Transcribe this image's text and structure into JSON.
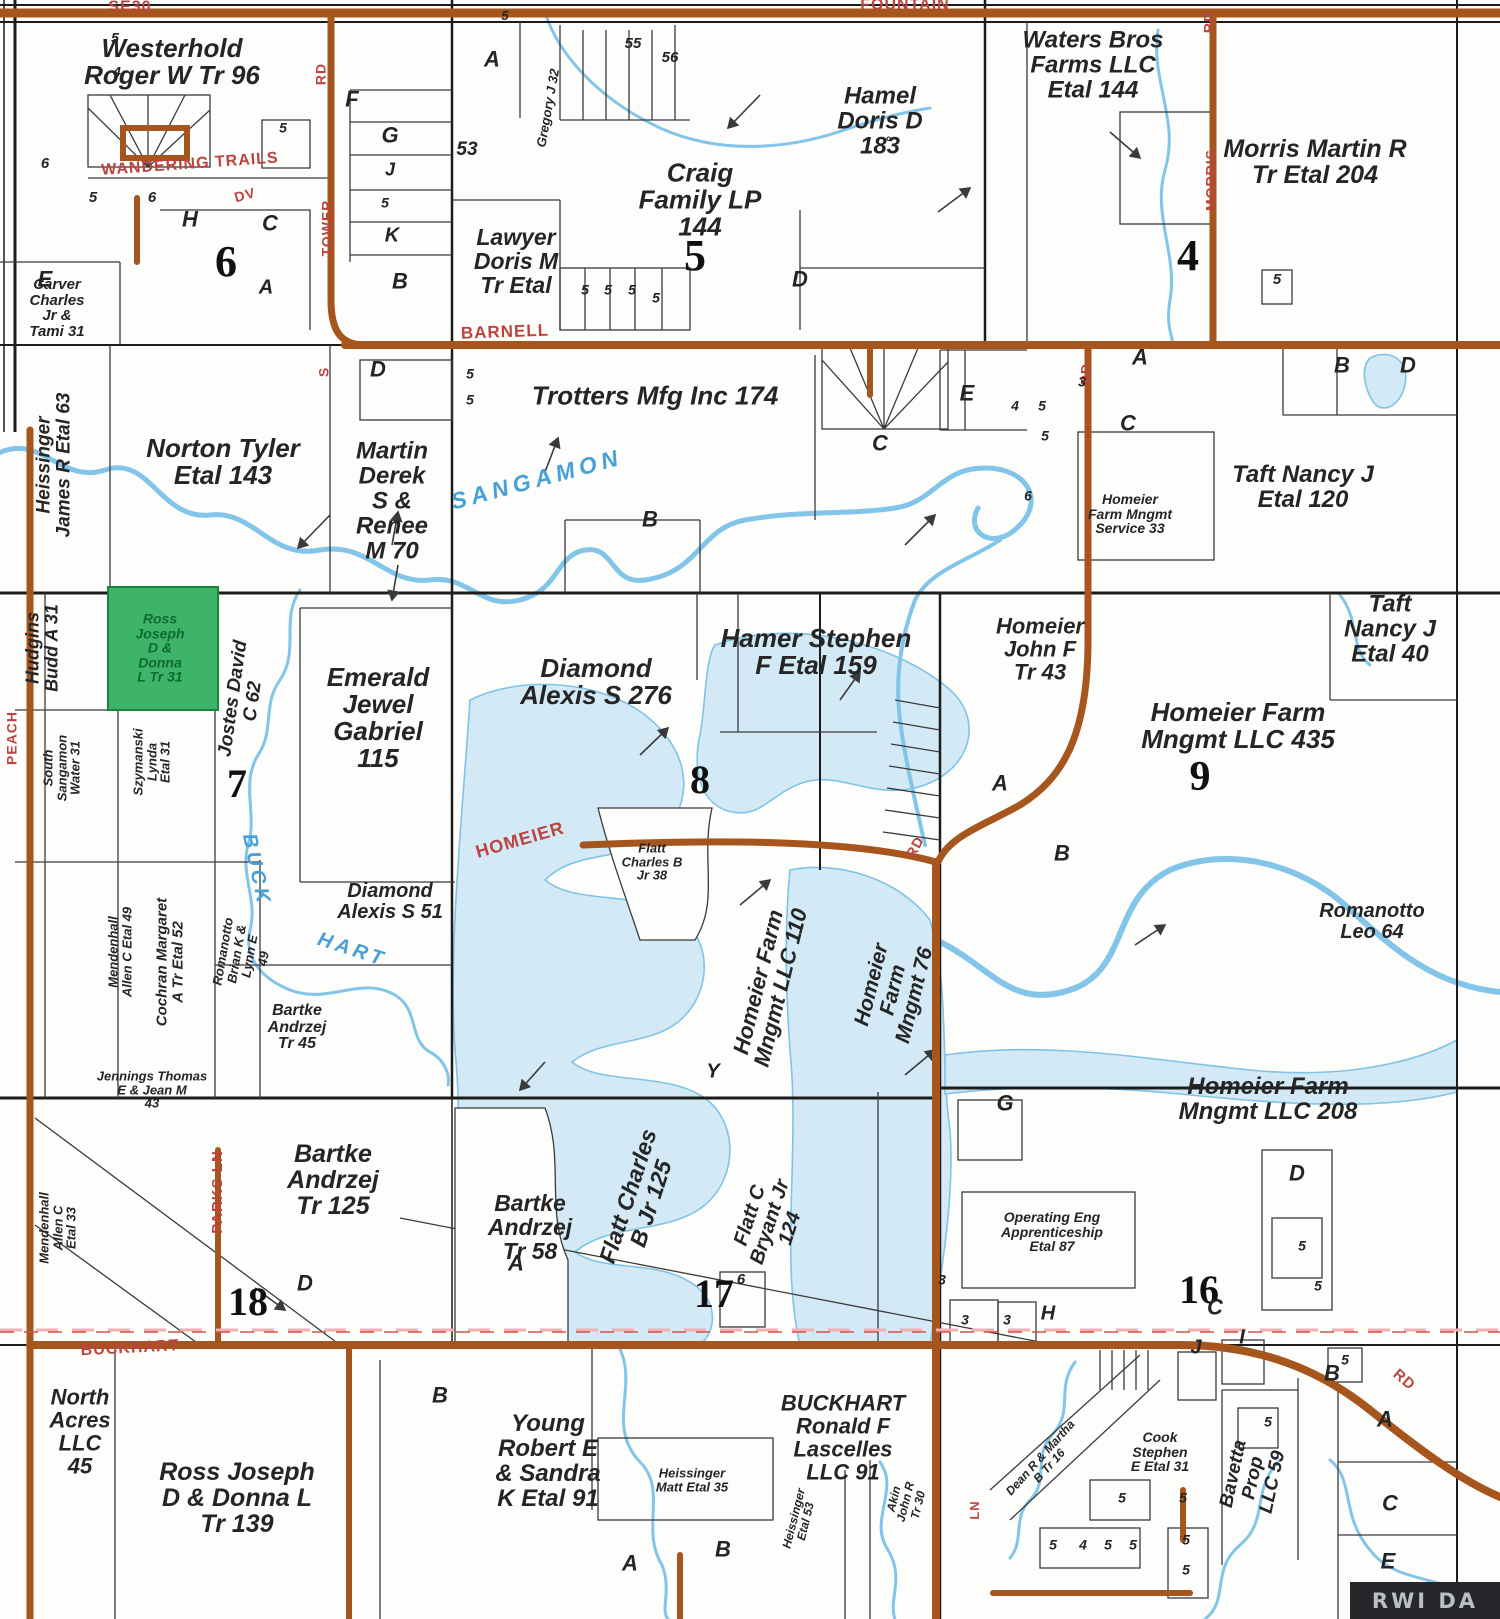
{
  "map_title": "Plat map - township land ownership",
  "colors": {
    "road_brown": "#a6561d",
    "road_label_red": "#bc4340",
    "water_fill": "#d3e9f6",
    "water_stroke": "#7fc4e6",
    "highlight_green": "#3db468",
    "highlight_text": "#0d6b33",
    "parcel_line": "#3a3a3a",
    "section_line": "#1c1c1c"
  },
  "highlight_parcel": {
    "owner": "Ross Joseph D & Donna L Tr 31"
  },
  "watermark": {
    "text": "RWI DA"
  },
  "sections": [
    {
      "t": "6",
      "x": 226,
      "y": 262,
      "fs": 44
    },
    {
      "t": "5",
      "x": 695,
      "y": 256,
      "fs": 44
    },
    {
      "t": "4",
      "x": 1188,
      "y": 256,
      "fs": 44
    },
    {
      "t": "7",
      "x": 237,
      "y": 784,
      "fs": 40
    },
    {
      "t": "8",
      "x": 700,
      "y": 780,
      "fs": 40
    },
    {
      "t": "9",
      "x": 1200,
      "y": 778,
      "fs": 42
    },
    {
      "t": "18",
      "x": 248,
      "y": 1302,
      "fs": 40
    },
    {
      "t": "17",
      "x": 714,
      "y": 1294,
      "fs": 40
    },
    {
      "t": "16",
      "x": 1199,
      "y": 1290,
      "fs": 40
    }
  ],
  "parcels": [
    {
      "id": "westerhold",
      "lines": [
        "Westerhold",
        "Roger W Tr 96"
      ],
      "x": 172,
      "y": 62,
      "fs": 26
    },
    {
      "id": "carver",
      "lines": [
        "Carver",
        "Charles",
        "Jr &",
        "Tami 31"
      ],
      "x": 57,
      "y": 308,
      "fs": 15
    },
    {
      "id": "craig",
      "lines": [
        "Craig",
        "Family LP",
        "144"
      ],
      "x": 700,
      "y": 200,
      "fs": 26
    },
    {
      "id": "lawyer",
      "lines": [
        "Lawyer",
        "Doris M",
        "Tr Etal"
      ],
      "x": 516,
      "y": 262,
      "fs": 23
    },
    {
      "id": "hamel",
      "lines": [
        "Hamel",
        "Doris D",
        "183"
      ],
      "x": 880,
      "y": 122,
      "fs": 24
    },
    {
      "id": "waters-bros",
      "lines": [
        "Waters Bros",
        "Farms LLC",
        "Etal 144"
      ],
      "x": 1093,
      "y": 66,
      "fs": 24
    },
    {
      "id": "morris-martin",
      "lines": [
        "Morris Martin R",
        "Tr Etal 204"
      ],
      "x": 1315,
      "y": 162,
      "fs": 25
    },
    {
      "id": "trotters",
      "lines": [
        "Trotters Mfg Inc 174"
      ],
      "x": 655,
      "y": 396,
      "fs": 26
    },
    {
      "id": "norton",
      "lines": [
        "Norton Tyler",
        "Etal 143"
      ],
      "x": 223,
      "y": 462,
      "fs": 26
    },
    {
      "id": "martin-derek",
      "lines": [
        "Martin",
        "Derek",
        "S &",
        "Renee",
        "M 70"
      ],
      "x": 392,
      "y": 502,
      "fs": 24
    },
    {
      "id": "taft-120",
      "lines": [
        "Taft Nancy J",
        "Etal 120"
      ],
      "x": 1303,
      "y": 488,
      "fs": 24
    },
    {
      "id": "homeier-service",
      "lines": [
        "Homeier",
        "Farm Mngmt",
        "Service 33"
      ],
      "x": 1130,
      "y": 514,
      "fs": 14
    },
    {
      "id": "heissinger-63",
      "lines": [
        "Heissinger",
        "James R Etal 63"
      ],
      "x": 54,
      "y": 465,
      "fs": 19,
      "rot": -90
    },
    {
      "id": "hudgins",
      "lines": [
        "Hudgins",
        "Budd A 31"
      ],
      "x": 42,
      "y": 648,
      "fs": 18,
      "rot": -90
    },
    {
      "id": "ross-31",
      "lines": [
        "Ross",
        "Joseph",
        "D &",
        "Donna",
        "L Tr 31"
      ],
      "x": 160,
      "y": 648,
      "fs": 14,
      "c": "#0d6b33"
    },
    {
      "id": "south-sangamon",
      "lines": [
        "South",
        "Sangamon",
        "Water 31"
      ],
      "x": 62,
      "y": 768,
      "fs": 13,
      "rot": -90
    },
    {
      "id": "szymanski",
      "lines": [
        "Szymanski",
        "Lynda",
        "Etal 31"
      ],
      "x": 152,
      "y": 762,
      "fs": 13,
      "rot": -90
    },
    {
      "id": "jostes",
      "lines": [
        "Jostes David",
        "C 62"
      ],
      "x": 243,
      "y": 700,
      "fs": 19,
      "rot": -82
    },
    {
      "id": "emerald",
      "lines": [
        "Emerald",
        "Jewel",
        "Gabriel",
        "115"
      ],
      "x": 378,
      "y": 718,
      "fs": 26
    },
    {
      "id": "diamond-276",
      "lines": [
        "Diamond",
        "Alexis S 276"
      ],
      "x": 596,
      "y": 682,
      "fs": 26
    },
    {
      "id": "hamer",
      "lines": [
        "Hamer Stephen",
        "F Etal 159"
      ],
      "x": 816,
      "y": 652,
      "fs": 26
    },
    {
      "id": "homeier-john",
      "lines": [
        "Homeier",
        "John F",
        "Tr 43"
      ],
      "x": 1040,
      "y": 650,
      "fs": 22
    },
    {
      "id": "taft-40",
      "lines": [
        "Taft",
        "Nancy J",
        "Etal 40"
      ],
      "x": 1390,
      "y": 630,
      "fs": 24
    },
    {
      "id": "homeier-435",
      "lines": [
        "Homeier Farm",
        "Mngmt LLC 435"
      ],
      "x": 1238,
      "y": 726,
      "fs": 26
    },
    {
      "id": "mendenhall-49",
      "lines": [
        "Mendenhall",
        "Allen C Etal 49"
      ],
      "x": 120,
      "y": 952,
      "fs": 13,
      "rot": -90
    },
    {
      "id": "cochran",
      "lines": [
        "Cochran Margaret",
        "A Tr Etal 52"
      ],
      "x": 170,
      "y": 962,
      "fs": 15,
      "rot": -90
    },
    {
      "id": "romanotto-brian",
      "lines": [
        "Romanotto",
        "Brian K &",
        "Lynn E",
        "49"
      ],
      "x": 243,
      "y": 955,
      "fs": 13,
      "rot": -80
    },
    {
      "id": "diamond-51",
      "lines": [
        "Diamond",
        "Alexis S 51"
      ],
      "x": 390,
      "y": 902,
      "fs": 20
    },
    {
      "id": "flatt-38",
      "lines": [
        "Flatt",
        "Charles B",
        "Jr 38"
      ],
      "x": 652,
      "y": 862,
      "fs": 13
    },
    {
      "id": "homeier-110",
      "lines": [
        "Homeier Farm",
        "Mngmt LLC 110"
      ],
      "x": 770,
      "y": 985,
      "fs": 22,
      "rot": -76
    },
    {
      "id": "homeier-76",
      "lines": [
        "Homeier",
        "Farm",
        "Mngmt 76"
      ],
      "x": 893,
      "y": 990,
      "fs": 21,
      "rot": -76
    },
    {
      "id": "romanotto-leo",
      "lines": [
        "Romanotto",
        "Leo 64"
      ],
      "x": 1372,
      "y": 922,
      "fs": 20
    },
    {
      "id": "bartke-45",
      "lines": [
        "Bartke",
        "Andrzej",
        "Tr 45"
      ],
      "x": 297,
      "y": 1028,
      "fs": 16
    },
    {
      "id": "jennings",
      "lines": [
        "Jennings Thomas",
        "E & Jean M",
        "43"
      ],
      "x": 152,
      "y": 1090,
      "fs": 13
    },
    {
      "id": "bartke-125",
      "lines": [
        "Bartke",
        "Andrzej",
        "Tr 125"
      ],
      "x": 333,
      "y": 1180,
      "fs": 25
    },
    {
      "id": "bartke-58",
      "lines": [
        "Bartke",
        "Andrzej",
        "Tr 58"
      ],
      "x": 530,
      "y": 1228,
      "fs": 23
    },
    {
      "id": "flatt-125",
      "lines": [
        "Flatt Charles",
        "B Jr 125"
      ],
      "x": 640,
      "y": 1200,
      "fs": 23,
      "rot": -72
    },
    {
      "id": "flatt-124",
      "lines": [
        "Flatt C",
        "Bryant Jr",
        "124"
      ],
      "x": 770,
      "y": 1222,
      "fs": 20,
      "rot": -72
    },
    {
      "id": "homeier-208",
      "lines": [
        "Homeier Farm",
        "Mngmt LLC 208"
      ],
      "x": 1268,
      "y": 1100,
      "fs": 24
    },
    {
      "id": "operating-eng",
      "lines": [
        "Operating Eng",
        "Apprenticeship",
        "Etal 87"
      ],
      "x": 1052,
      "y": 1232,
      "fs": 14
    },
    {
      "id": "mendenhall-33",
      "lines": [
        "Mendenhall",
        "Allen C",
        "Etal 33"
      ],
      "x": 58,
      "y": 1228,
      "fs": 13,
      "rot": -90
    },
    {
      "id": "north-acres",
      "lines": [
        "North",
        "Acres",
        "LLC",
        "45"
      ],
      "x": 80,
      "y": 1432,
      "fs": 22
    },
    {
      "id": "ross-139",
      "lines": [
        "Ross Joseph",
        "D & Donna L",
        "Tr 139"
      ],
      "x": 237,
      "y": 1498,
      "fs": 25
    },
    {
      "id": "young",
      "lines": [
        "Young",
        "Robert E",
        "& Sandra",
        "K Etal 91"
      ],
      "x": 548,
      "y": 1462,
      "fs": 24
    },
    {
      "id": "heissinger-35",
      "lines": [
        "Heissinger",
        "Matt Etal 35"
      ],
      "x": 692,
      "y": 1480,
      "fs": 13
    },
    {
      "id": "lascelles",
      "lines": [
        "BUCKHART",
        "Ronald F",
        "Lascelles",
        "LLC 91"
      ],
      "x": 843,
      "y": 1438,
      "fs": 22
    },
    {
      "id": "cook",
      "lines": [
        "Cook",
        "Stephen",
        "E Etal 31"
      ],
      "x": 1160,
      "y": 1452,
      "fs": 14
    },
    {
      "id": "bavetta",
      "lines": [
        "Bavetta",
        "Prop",
        "LLC 59"
      ],
      "x": 1253,
      "y": 1478,
      "fs": 19,
      "rot": -78
    },
    {
      "id": "dean",
      "lines": [
        "Dean R & Martha",
        "B Tr 16"
      ],
      "x": 1045,
      "y": 1462,
      "fs": 12,
      "rot": -48
    },
    {
      "id": "akin",
      "lines": [
        "Akin",
        "John R",
        "Tr 30"
      ],
      "x": 906,
      "y": 1502,
      "fs": 12,
      "rot": -76
    },
    {
      "id": "heissinger-53",
      "lines": [
        "Heissinger",
        "Etal 53"
      ],
      "x": 800,
      "y": 1520,
      "fs": 12,
      "rot": -76
    },
    {
      "id": "gregory",
      "lines": [
        "Gregory J 32"
      ],
      "x": 548,
      "y": 108,
      "fs": 13,
      "rot": -80
    }
  ],
  "road_labels": [
    {
      "t": "SE30",
      "x": 130,
      "y": 8,
      "fs": 16
    },
    {
      "t": "FOUNTAIN",
      "x": 905,
      "y": 6,
      "fs": 16
    },
    {
      "t": "WANDERING TRAILS",
      "x": 190,
      "y": 165,
      "fs": 16,
      "rot": -4
    },
    {
      "t": "DV",
      "x": 245,
      "y": 195,
      "fs": 14,
      "rot": -15
    },
    {
      "t": "RD",
      "x": 321,
      "y": 74,
      "fs": 14,
      "rot": -90
    },
    {
      "t": "TOWER",
      "x": 327,
      "y": 228,
      "fs": 14,
      "rot": -90
    },
    {
      "t": "S",
      "x": 324,
      "y": 372,
      "fs": 14,
      "rot": -90
    },
    {
      "t": "BARNELL",
      "x": 505,
      "y": 332,
      "fs": 17,
      "rot": -2
    },
    {
      "t": "RD",
      "x": 1209,
      "y": 22,
      "fs": 14,
      "rot": -90
    },
    {
      "t": "MORRIS",
      "x": 1211,
      "y": 180,
      "fs": 14,
      "rot": -90
    },
    {
      "t": "RD",
      "x": 1086,
      "y": 374,
      "fs": 14,
      "rot": -90
    },
    {
      "t": "HOMEIER",
      "x": 520,
      "y": 840,
      "fs": 18,
      "rot": -16
    },
    {
      "t": "RD",
      "x": 915,
      "y": 847,
      "fs": 14,
      "rot": -62
    },
    {
      "t": "PARKS LN",
      "x": 218,
      "y": 1192,
      "fs": 15,
      "rot": -90
    },
    {
      "t": "PEACH",
      "x": 12,
      "y": 738,
      "fs": 14,
      "rot": -90
    },
    {
      "t": "BUCKHART",
      "x": 130,
      "y": 1349,
      "fs": 16,
      "rot": -3
    },
    {
      "t": "RD",
      "x": 1404,
      "y": 1380,
      "fs": 15,
      "rot": 40
    },
    {
      "t": "LN",
      "x": 975,
      "y": 1510,
      "fs": 13,
      "rot": -90
    }
  ],
  "water_labels": [
    {
      "t": "SANGAMON",
      "x": 537,
      "y": 480,
      "fs": 23,
      "rot": -15,
      "ls": 5
    },
    {
      "t": "BUCK",
      "x": 256,
      "y": 870,
      "fs": 20,
      "rot": 78,
      "ls": 4
    },
    {
      "t": "HART",
      "x": 352,
      "y": 950,
      "fs": 20,
      "rot": 18,
      "ls": 4
    }
  ],
  "small_marks": [
    {
      "t": "5",
      "x": 115,
      "y": 38,
      "fs": 14
    },
    {
      "t": "4",
      "x": 117,
      "y": 72,
      "fs": 14
    },
    {
      "t": "F",
      "x": 352,
      "y": 100,
      "fs": 22
    },
    {
      "t": "G",
      "x": 390,
      "y": 136,
      "fs": 22
    },
    {
      "t": "J",
      "x": 390,
      "y": 170,
      "fs": 18
    },
    {
      "t": "5",
      "x": 385,
      "y": 203,
      "fs": 14
    },
    {
      "t": "K",
      "x": 392,
      "y": 236,
      "fs": 20
    },
    {
      "t": "A",
      "x": 492,
      "y": 60,
      "fs": 22
    },
    {
      "t": "53",
      "x": 467,
      "y": 150,
      "fs": 19
    },
    {
      "t": "55",
      "x": 633,
      "y": 44,
      "fs": 15
    },
    {
      "t": "56",
      "x": 670,
      "y": 58,
      "fs": 15
    },
    {
      "t": "5",
      "x": 505,
      "y": 16,
      "fs": 13
    },
    {
      "t": "6",
      "x": 45,
      "y": 164,
      "fs": 15
    },
    {
      "t": "5",
      "x": 93,
      "y": 198,
      "fs": 15
    },
    {
      "t": "6",
      "x": 152,
      "y": 198,
      "fs": 15
    },
    {
      "t": "5",
      "x": 283,
      "y": 128,
      "fs": 14
    },
    {
      "t": "H",
      "x": 190,
      "y": 220,
      "fs": 22
    },
    {
      "t": "C",
      "x": 270,
      "y": 224,
      "fs": 22
    },
    {
      "t": "E",
      "x": 45,
      "y": 280,
      "fs": 22
    },
    {
      "t": "B",
      "x": 400,
      "y": 282,
      "fs": 22
    },
    {
      "t": "A",
      "x": 266,
      "y": 288,
      "fs": 20
    },
    {
      "t": "5",
      "x": 585,
      "y": 290,
      "fs": 14
    },
    {
      "t": "5",
      "x": 608,
      "y": 290,
      "fs": 14
    },
    {
      "t": "5",
      "x": 632,
      "y": 290,
      "fs": 14
    },
    {
      "t": "5",
      "x": 656,
      "y": 298,
      "fs": 14
    },
    {
      "t": "D",
      "x": 800,
      "y": 280,
      "fs": 22
    },
    {
      "t": "D",
      "x": 378,
      "y": 370,
      "fs": 22
    },
    {
      "t": "5",
      "x": 470,
      "y": 374,
      "fs": 14
    },
    {
      "t": "5",
      "x": 470,
      "y": 400,
      "fs": 14
    },
    {
      "t": "E",
      "x": 967,
      "y": 394,
      "fs": 22
    },
    {
      "t": "C",
      "x": 880,
      "y": 444,
      "fs": 22
    },
    {
      "t": "B",
      "x": 650,
      "y": 520,
      "fs": 22
    },
    {
      "t": "A",
      "x": 1140,
      "y": 358,
      "fs": 22
    },
    {
      "t": "3",
      "x": 1082,
      "y": 382,
      "fs": 14
    },
    {
      "t": "4",
      "x": 1015,
      "y": 406,
      "fs": 14
    },
    {
      "t": "5",
      "x": 1042,
      "y": 406,
      "fs": 14
    },
    {
      "t": "5",
      "x": 1045,
      "y": 436,
      "fs": 14
    },
    {
      "t": "C",
      "x": 1128,
      "y": 424,
      "fs": 22
    },
    {
      "t": "6",
      "x": 1028,
      "y": 496,
      "fs": 14
    },
    {
      "t": "B",
      "x": 1342,
      "y": 366,
      "fs": 22
    },
    {
      "t": "D",
      "x": 1408,
      "y": 366,
      "fs": 22
    },
    {
      "t": "5",
      "x": 1277,
      "y": 280,
      "fs": 15
    },
    {
      "t": "°",
      "x": 888,
      "y": 142,
      "fs": 14
    },
    {
      "t": "A",
      "x": 1000,
      "y": 784,
      "fs": 22
    },
    {
      "t": "B",
      "x": 1062,
      "y": 854,
      "fs": 22
    },
    {
      "t": "Y",
      "x": 713,
      "y": 1072,
      "fs": 20
    },
    {
      "t": "G",
      "x": 1005,
      "y": 1104,
      "fs": 22
    },
    {
      "t": "D",
      "x": 1297,
      "y": 1174,
      "fs": 22
    },
    {
      "t": "5",
      "x": 1302,
      "y": 1246,
      "fs": 14
    },
    {
      "t": "5",
      "x": 1318,
      "y": 1286,
      "fs": 14
    },
    {
      "t": "H",
      "x": 1048,
      "y": 1314,
      "fs": 20
    },
    {
      "t": "3",
      "x": 942,
      "y": 1280,
      "fs": 14
    },
    {
      "t": "3",
      "x": 965,
      "y": 1320,
      "fs": 14
    },
    {
      "t": "3",
      "x": 1007,
      "y": 1320,
      "fs": 14
    },
    {
      "t": "C",
      "x": 1215,
      "y": 1308,
      "fs": 22
    },
    {
      "t": "6",
      "x": 741,
      "y": 1280,
      "fs": 15
    },
    {
      "t": "D",
      "x": 305,
      "y": 1284,
      "fs": 22
    },
    {
      "t": "A",
      "x": 516,
      "y": 1264,
      "fs": 22
    },
    {
      "t": "B",
      "x": 440,
      "y": 1396,
      "fs": 22
    },
    {
      "t": "B",
      "x": 1332,
      "y": 1374,
      "fs": 22
    },
    {
      "t": "J",
      "x": 1196,
      "y": 1348,
      "fs": 20
    },
    {
      "t": "I",
      "x": 1242,
      "y": 1338,
      "fs": 20
    },
    {
      "t": "5",
      "x": 1345,
      "y": 1360,
      "fs": 14
    },
    {
      "t": "5",
      "x": 1268,
      "y": 1422,
      "fs": 14
    },
    {
      "t": "A",
      "x": 1385,
      "y": 1420,
      "fs": 22
    },
    {
      "t": "C",
      "x": 1390,
      "y": 1504,
      "fs": 22
    },
    {
      "t": "E",
      "x": 1388,
      "y": 1562,
      "fs": 22
    },
    {
      "t": "A",
      "x": 630,
      "y": 1564,
      "fs": 22
    },
    {
      "t": "B",
      "x": 723,
      "y": 1550,
      "fs": 22
    },
    {
      "t": "5",
      "x": 1053,
      "y": 1545,
      "fs": 14
    },
    {
      "t": "4",
      "x": 1083,
      "y": 1545,
      "fs": 14
    },
    {
      "t": "5",
      "x": 1108,
      "y": 1545,
      "fs": 14
    },
    {
      "t": "5",
      "x": 1133,
      "y": 1545,
      "fs": 14
    },
    {
      "t": "5",
      "x": 1186,
      "y": 1540,
      "fs": 14
    },
    {
      "t": "5",
      "x": 1186,
      "y": 1570,
      "fs": 14
    },
    {
      "t": "5",
      "x": 1122,
      "y": 1498,
      "fs": 14
    },
    {
      "t": "5",
      "x": 1183,
      "y": 1498,
      "fs": 14
    },
    {
      "t": "5",
      "x": 1467,
      "y": 1596,
      "fs": 14
    }
  ]
}
